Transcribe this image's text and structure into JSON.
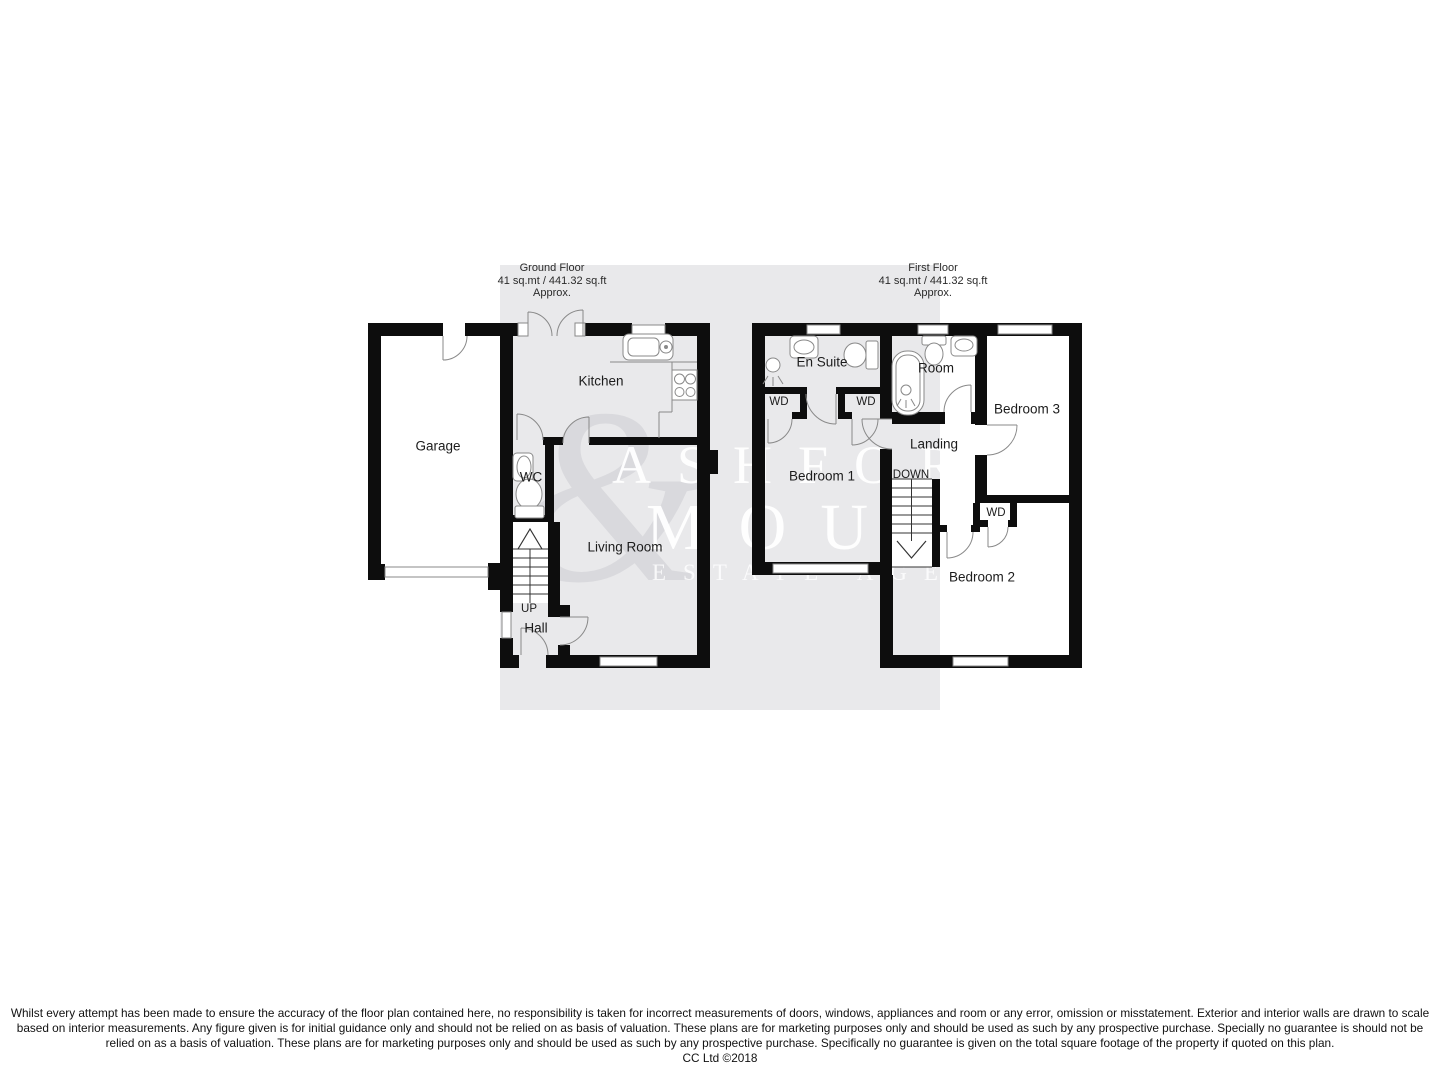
{
  "floorplan": {
    "ground_floor": {
      "title": "Ground Floor",
      "area": "41 sq.mt / 441.32 sq.ft",
      "approx": "Approx.",
      "rooms": {
        "garage": "Garage",
        "kitchen": "Kitchen",
        "wc": "WC",
        "living_room": "Living Room",
        "hall": "Hall",
        "stairs_direction": "UP"
      }
    },
    "first_floor": {
      "title": "First Floor",
      "area": "41 sq.mt / 441.32 sq.ft",
      "approx": "Approx.",
      "rooms": {
        "en_suite": "En Suite",
        "room": "Room",
        "bedroom_3": "Bedroom 3",
        "wd_1": "WD",
        "wd_2": "WD",
        "landing": "Landing",
        "bedroom_1": "Bedroom 1",
        "stairs_direction": "DOWN",
        "wd_3": "WD",
        "bedroom_2": "Bedroom 2"
      }
    },
    "watermark": {
      "ampersand": "&",
      "line1": "ASHFORD",
      "line2": "MOULT",
      "line3": "ESTATE AGENT"
    },
    "footer": {
      "disclaimer": "Whilst every attempt has been made to ensure the accuracy of the floor plan contained here, no responsibility is taken for incorrect measurements of doors, windows, appliances and room or any error, omission or misstatement. Exterior and interior walls are drawn to scale based on interior measurements. Any figure given is for initial guidance only and should not be relied on as basis of valuation. These plans are for marketing purposes only and should be used as such by any prospective purchase. Specially no guarantee is should not be relied on as a basis of valuation. These plans are for marketing purposes only and should be used as such by any prospective purchase. Specifically no guarantee is given on the total square footage of the property if quoted on this plan.",
      "copyright": "CC Ltd ©2018"
    },
    "colors": {
      "background": "#ffffff",
      "plan_band": "#e9e9eb",
      "wall": "#0d0d0d",
      "fixture_stroke": "#898989",
      "label_text": "#1c1c1c",
      "watermark_text": "#ffffff"
    }
  }
}
